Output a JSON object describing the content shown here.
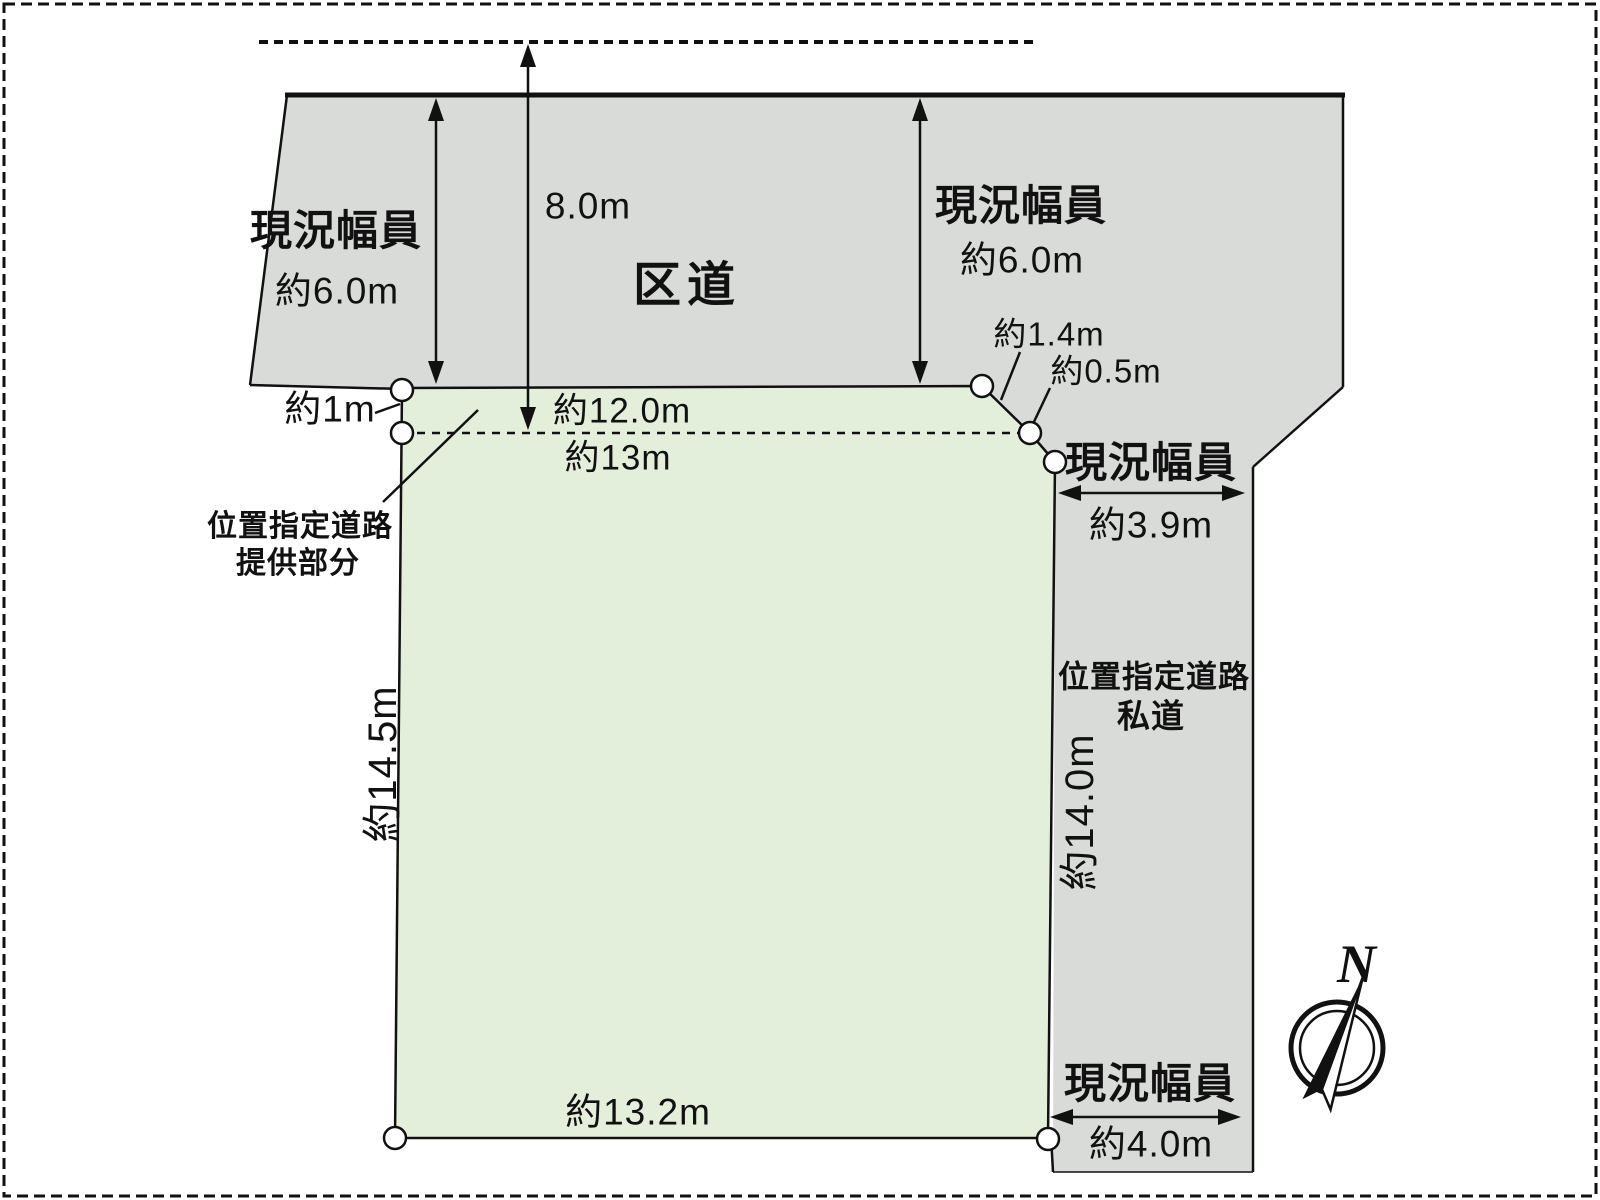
{
  "colors": {
    "road_fill": "#d9dbd8",
    "plot_fill": "#e4efdb",
    "line": "#111111"
  },
  "ward_road": {
    "name": "区道",
    "left_width_label": "現況幅員",
    "left_width_value": "約6.0m",
    "right_width_label": "現況幅員",
    "right_width_value": "約6.0m",
    "planned_width_value": "8.0m"
  },
  "plot": {
    "setback_depth": "約1m",
    "front_width_setback": "約12.0m",
    "front_width_total": "約13m",
    "corner_cut_upper": "約1.4m",
    "corner_cut_lower": "約0.5m",
    "left_depth": "約14.5m",
    "bottom_width": "約13.2m",
    "provided_area_line1": "位置指定道路",
    "provided_area_line2": "提供部分"
  },
  "private_road": {
    "name_line1": "位置指定道路",
    "name_line2": "私道",
    "top_width_label": "現況幅員",
    "top_width_value": "約3.9m",
    "depth": "約14.0m",
    "bottom_width_label": "現況幅員",
    "bottom_width_value": "約4.0m"
  },
  "compass": {
    "north_label": "N"
  }
}
